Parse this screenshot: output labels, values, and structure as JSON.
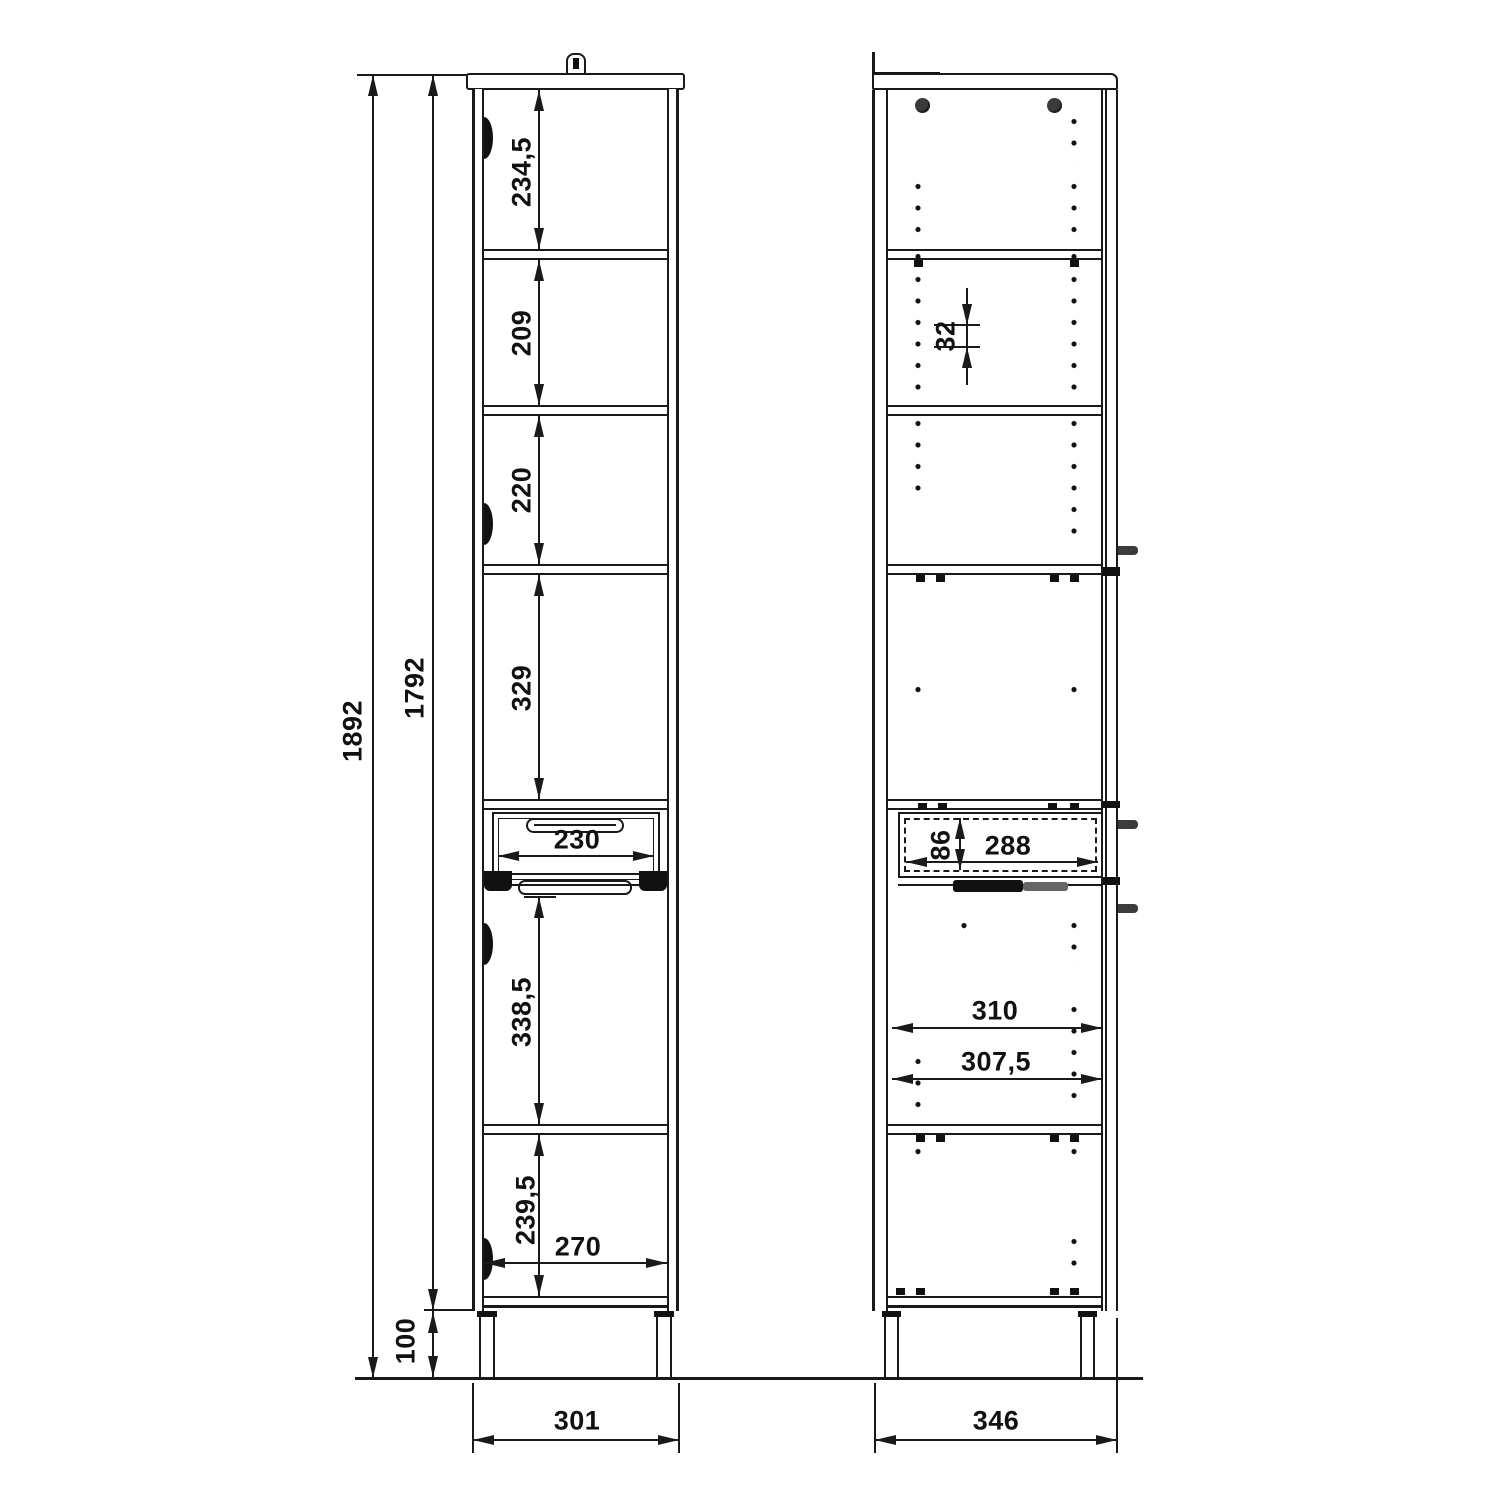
{
  "drawing_title": "tall cabinet technical drawing",
  "front_view": {
    "dims": {
      "total_height": "1892",
      "body_height": "1792",
      "plinth_height": "100",
      "section_1": "234,5",
      "section_2": "209",
      "section_3": "220",
      "section_4": "329",
      "drawer_width": "230",
      "section_5": "338,5",
      "section_6": "239,5",
      "interior_width": "270",
      "overall_width": "301"
    }
  },
  "side_view": {
    "dims": {
      "hole_spacing": "32",
      "drawer_height": "86",
      "drawer_depth": "288",
      "interior_depth": "310",
      "shelf_depth": "307,5",
      "overall_depth": "346"
    }
  },
  "colors": {
    "line": "#1a1a1a",
    "background": "#ffffff"
  }
}
